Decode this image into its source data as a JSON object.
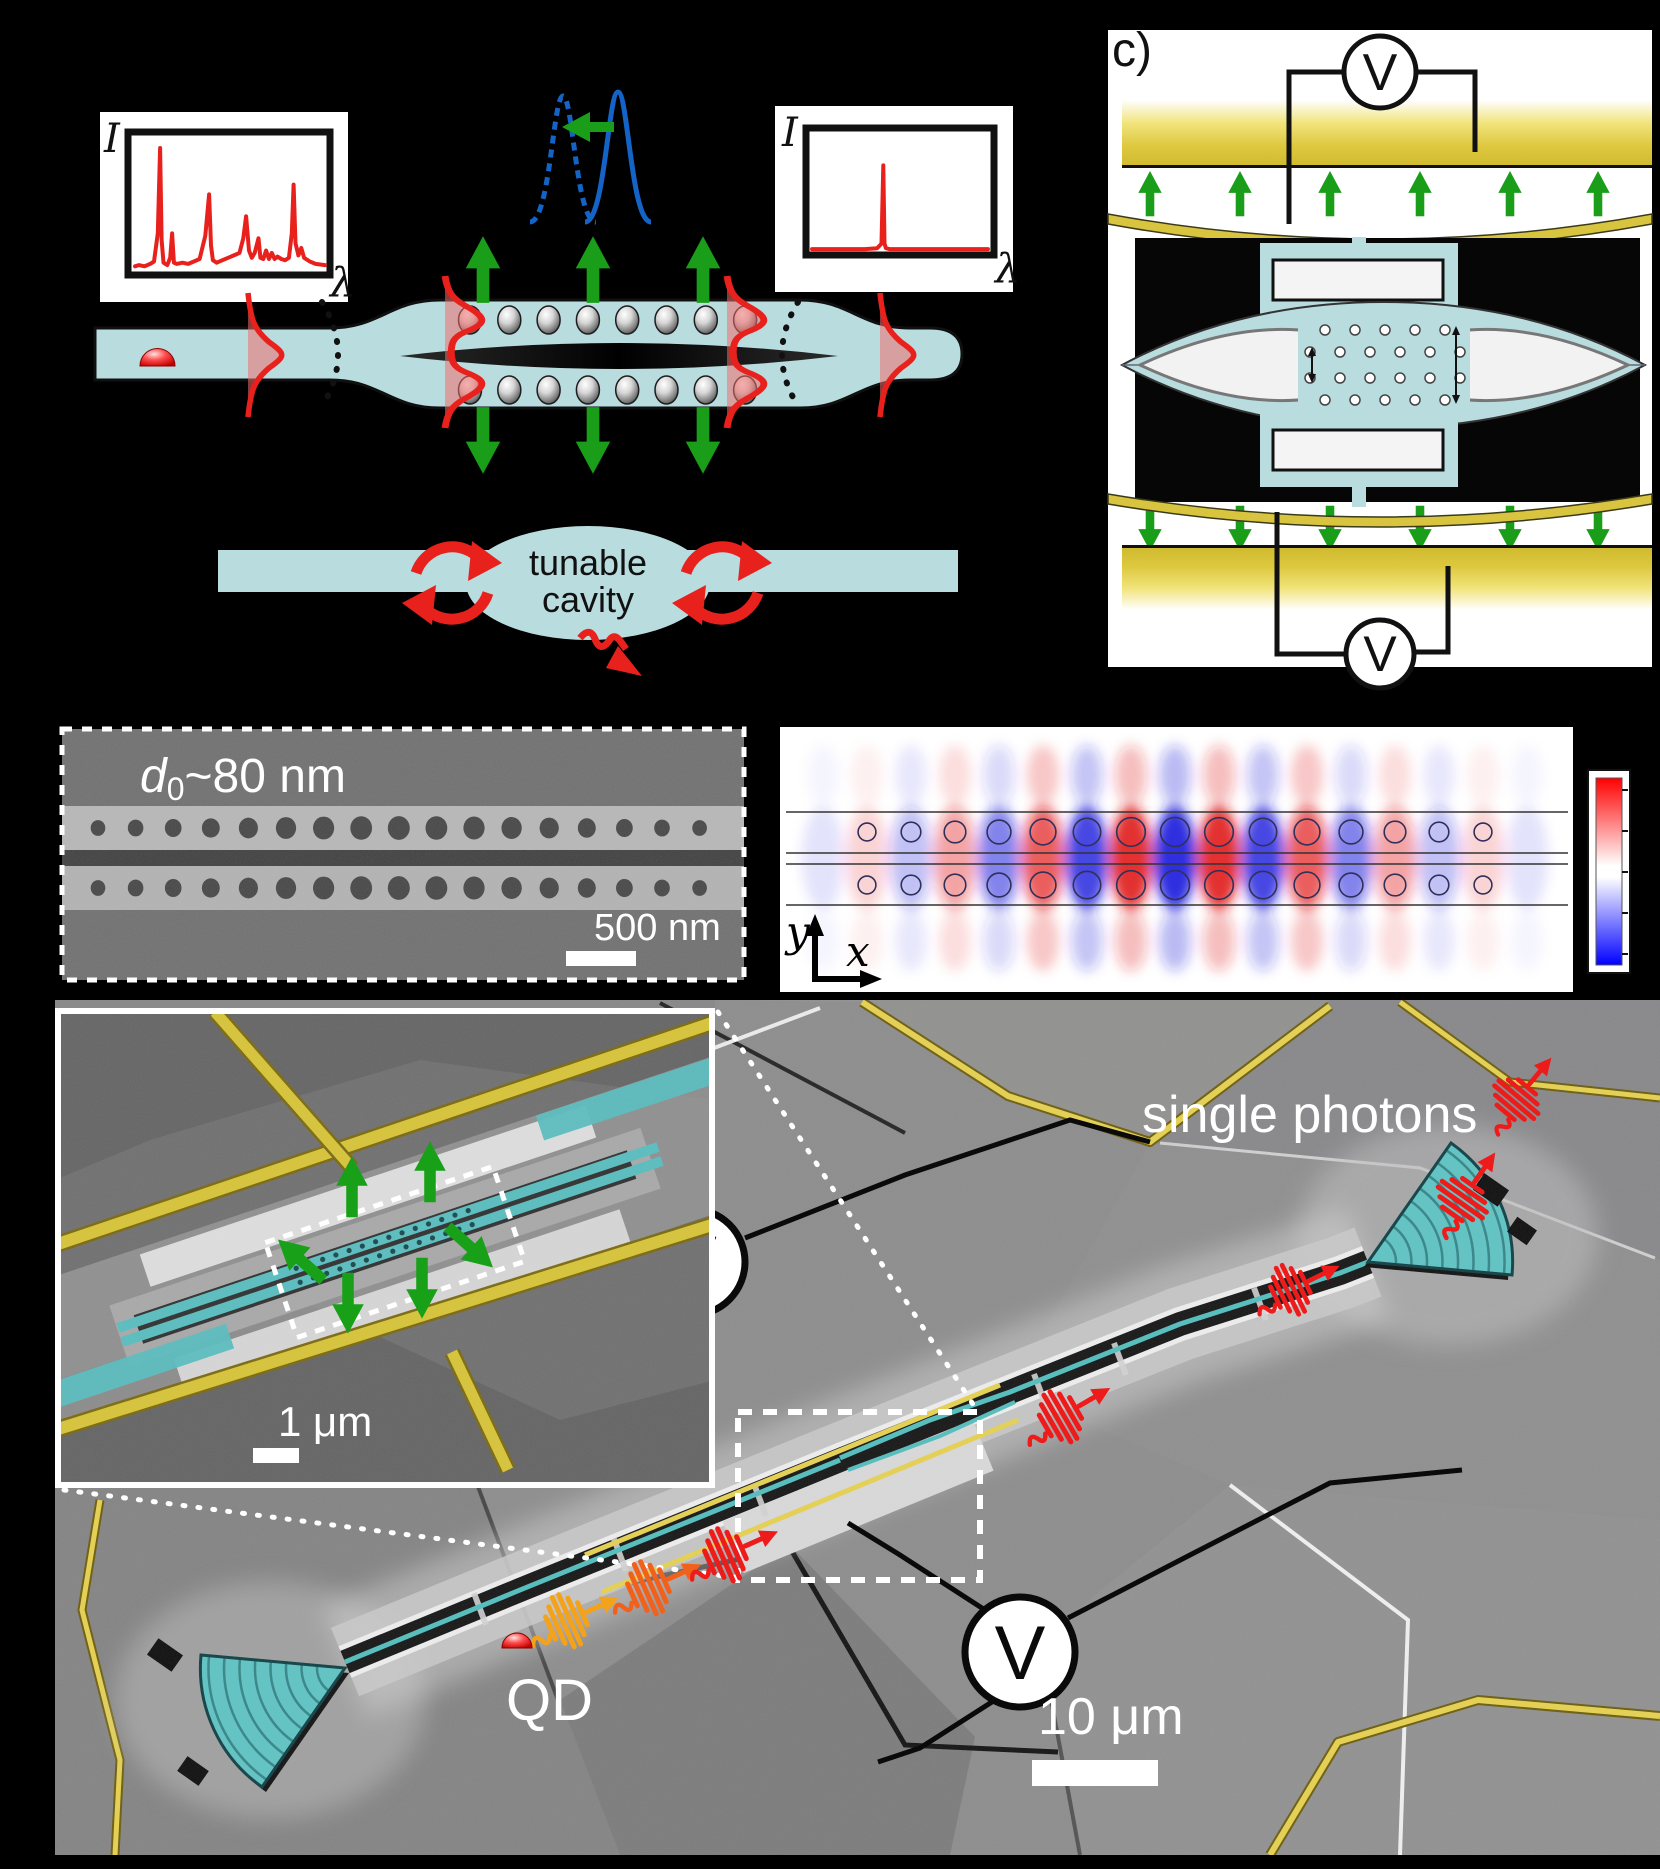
{
  "figure": {
    "background": "#000000"
  },
  "panel_a": {
    "left_spectrum": {
      "ylabel": "I",
      "xlabel": "λ"
    },
    "right_spectrum": {
      "ylabel": "I",
      "xlabel": "λ"
    },
    "cavity_bubble": {
      "line1": "tunable",
      "line2": "cavity"
    }
  },
  "panel_c": {
    "label": "c)",
    "voltmeter_top": "V",
    "voltmeter_bottom": "V"
  },
  "panel_d": {
    "gap_label": {
      "symbol": "d",
      "subscript": "0",
      "rest": "~80 nm"
    },
    "scale_bar": "500 nm"
  },
  "panel_e": {
    "xlabel": "x",
    "ylabel": "y"
  },
  "panel_f": {
    "photons_label": "single photons",
    "qd_label": "QD",
    "scale_bar": "10 μm",
    "inset_scale_bar": "1 μm",
    "voltmeter_left": "V",
    "voltmeter_right": "V"
  },
  "colors": {
    "schematic_blue": "#b9dcdf",
    "teal": "#52bdbd",
    "gold": "#d9c43f",
    "green": "#1a9e1a",
    "red": "#e8211d",
    "blue_peak": "#1464c8",
    "field_red": "#e01616",
    "field_blue": "#1b1bdc"
  },
  "icons": [
    {
      "name": "voltmeter-icon",
      "glyph": "circled V"
    },
    {
      "name": "photon-wavepacket-icon",
      "glyph": "oscillating burst with arrow"
    },
    {
      "name": "quantum-dot-icon",
      "glyph": "red dome"
    },
    {
      "name": "recycle-arrows-icon",
      "glyph": "two red circulating arrows"
    },
    {
      "name": "leak-arrow-icon",
      "glyph": "red squiggly arrow"
    },
    {
      "name": "tuning-arrow-icon",
      "glyph": "green left arrow"
    },
    {
      "name": "displacement-arrow-icon",
      "glyph": "green block arrow"
    }
  ],
  "chart_data": [
    {
      "id": "waveguide_emission_spectrum",
      "type": "line",
      "title": "QD emission spectrum in waveguide (multimode)",
      "xlabel": "λ",
      "ylabel": "I",
      "line_color": "#e8211d",
      "x": [
        0,
        0.02,
        0.05,
        0.08,
        0.1,
        0.12,
        0.132,
        0.14,
        0.15,
        0.17,
        0.185,
        0.195,
        0.205,
        0.22,
        0.25,
        0.28,
        0.31,
        0.34,
        0.37,
        0.39,
        0.4,
        0.41,
        0.43,
        0.46,
        0.49,
        0.52,
        0.55,
        0.57,
        0.585,
        0.6,
        0.615,
        0.63,
        0.65,
        0.66,
        0.675,
        0.69,
        0.705,
        0.72,
        0.735,
        0.75,
        0.77,
        0.79,
        0.81,
        0.825,
        0.835,
        0.845,
        0.86,
        0.875,
        0.89,
        0.92,
        0.95,
        1
      ],
      "y": [
        0.03,
        0.04,
        0.03,
        0.05,
        0.07,
        0.3,
        1.0,
        0.25,
        0.06,
        0.04,
        0.1,
        0.3,
        0.06,
        0.05,
        0.06,
        0.05,
        0.07,
        0.09,
        0.28,
        0.62,
        0.2,
        0.08,
        0.06,
        0.08,
        0.1,
        0.12,
        0.14,
        0.26,
        0.44,
        0.16,
        0.1,
        0.14,
        0.26,
        0.1,
        0.09,
        0.16,
        0.09,
        0.14,
        0.09,
        0.11,
        0.09,
        0.08,
        0.1,
        0.3,
        0.7,
        0.22,
        0.12,
        0.18,
        0.1,
        0.07,
        0.05,
        0.04
      ]
    },
    {
      "id": "cavity_filtered_spectrum",
      "type": "line",
      "title": "single cavity mode after tunable-cavity filtering",
      "xlabel": "λ",
      "ylabel": "I",
      "line_color": "#e8211d",
      "x": [
        0,
        0.3,
        0.37,
        0.395,
        0.405,
        0.412,
        0.42,
        0.44,
        0.5,
        1
      ],
      "y": [
        0.02,
        0.02,
        0.03,
        0.08,
        0.92,
        0.08,
        0.03,
        0.02,
        0.02,
        0.02
      ]
    },
    {
      "id": "cavity_mode_profile",
      "type": "heatmap",
      "title": "double-beam photonic-crystal cavity mode (field, red = +, blue = −)",
      "xlabel": "x",
      "ylabel": "y",
      "colorbar": {
        "top_color": "#ff0000",
        "mid_color": "#ffffff",
        "bottom_color": "#0000ff"
      },
      "beam_lines_y": [
        812,
        853,
        864,
        905
      ],
      "columns": [
        {
          "x": 823,
          "s": -1,
          "a": 0.12
        },
        {
          "x": 867,
          "s": 1,
          "a": 0.19
        },
        {
          "x": 911,
          "s": -1,
          "a": 0.3
        },
        {
          "x": 955,
          "s": 1,
          "a": 0.43
        },
        {
          "x": 999,
          "s": -1,
          "a": 0.58
        },
        {
          "x": 1043,
          "s": 1,
          "a": 0.74
        },
        {
          "x": 1087,
          "s": -1,
          "a": 0.87
        },
        {
          "x": 1131,
          "s": 1,
          "a": 0.97
        },
        {
          "x": 1175,
          "s": -1,
          "a": 1.0
        },
        {
          "x": 1219,
          "s": 1,
          "a": 0.97
        },
        {
          "x": 1263,
          "s": -1,
          "a": 0.87
        },
        {
          "x": 1307,
          "s": 1,
          "a": 0.74
        },
        {
          "x": 1351,
          "s": -1,
          "a": 0.58
        },
        {
          "x": 1395,
          "s": 1,
          "a": 0.43
        },
        {
          "x": 1439,
          "s": -1,
          "a": 0.3
        },
        {
          "x": 1483,
          "s": 1,
          "a": 0.19
        },
        {
          "x": 1527,
          "s": -1,
          "a": 0.12
        }
      ],
      "holes": {
        "row_y": [
          832,
          885
        ],
        "x": [
          867,
          911,
          955,
          999,
          1043,
          1087,
          1131,
          1175,
          1219,
          1263,
          1307,
          1351,
          1395,
          1439,
          1483
        ],
        "r": [
          8.9,
          9.8,
          10.8,
          11.9,
          12.9,
          13.7,
          14.3,
          14.5,
          14.3,
          13.7,
          12.9,
          11.9,
          10.8,
          9.8,
          8.9
        ]
      }
    }
  ]
}
